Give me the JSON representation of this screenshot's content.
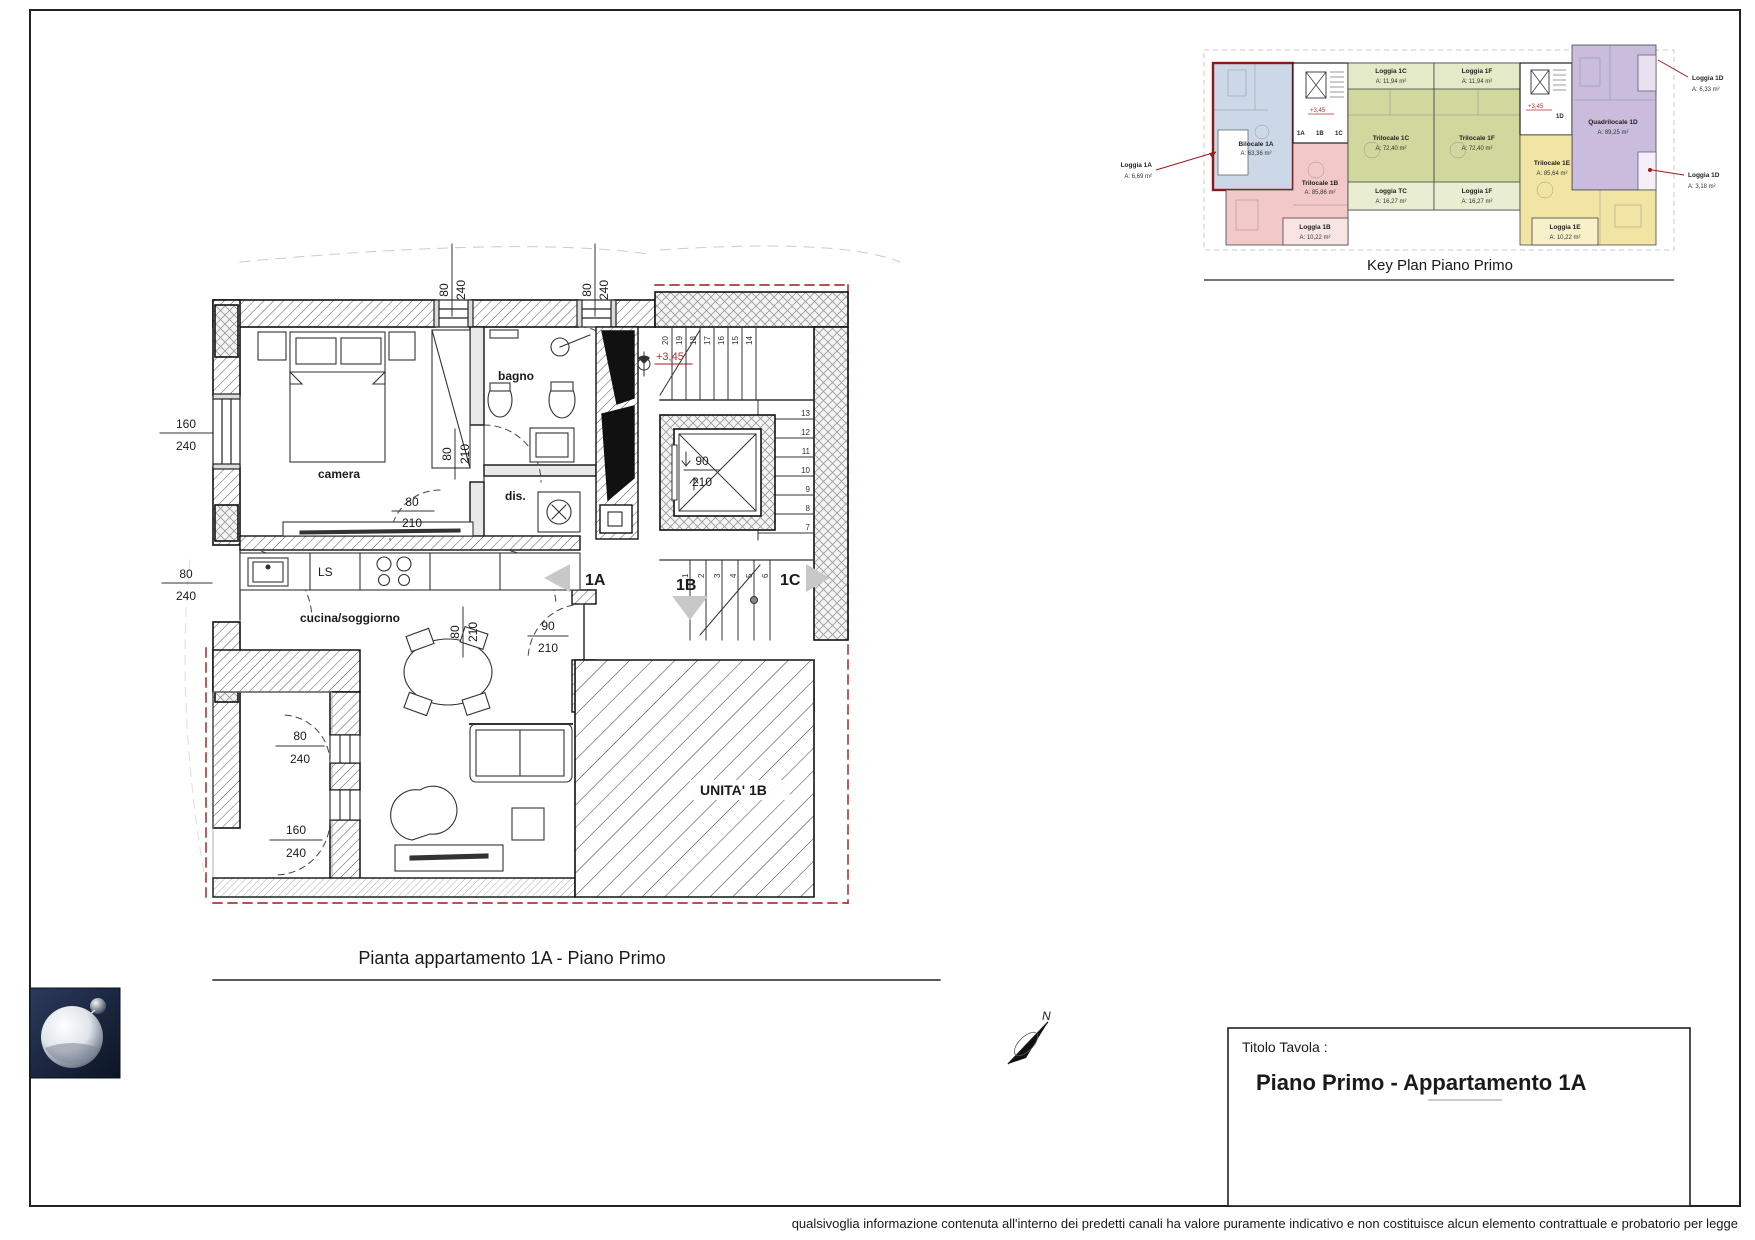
{
  "colors": {
    "red_accent": "#a01818",
    "unit_blue": "#ccd8e8",
    "unit_pink": "#f2c8c8",
    "unit_green": "#d0d89e",
    "unit_purple": "#c9bcdc",
    "unit_yellow": "#f2e5a4",
    "logo_navy": "#16233f"
  },
  "plan": {
    "title": "Pianta appartamento 1A - Piano Primo",
    "rooms": {
      "camera": "camera",
      "bagno": "bagno",
      "dis": "dis.",
      "cucina": "cucina/soggiorno",
      "ls": "LS",
      "unita1b": "UNITA' 1B"
    },
    "unit_markers": [
      "1A",
      "1B",
      "1C"
    ],
    "level": "+3,45",
    "dims": {
      "w80": "80",
      "w90": "90",
      "w160": "160",
      "h210": "210",
      "h240": "240"
    },
    "stairs_top": [
      "20",
      "19",
      "18",
      "17",
      "16",
      "15",
      "14"
    ],
    "stairs_right": [
      "13",
      "12",
      "11",
      "10",
      "9",
      "8",
      "7"
    ],
    "stairs_low": [
      "1",
      "2",
      "3",
      "4",
      "5",
      "6"
    ]
  },
  "keyplan": {
    "title": "Key Plan Piano Primo",
    "level": "+3,45",
    "unit_tags": [
      "1A",
      "1B",
      "1C",
      "1D"
    ],
    "units": [
      {
        "name": "Bilocale 1A",
        "area": "A: 63,36 m²"
      },
      {
        "name": "Trilocale 1B",
        "area": "A: 85,86 m²"
      },
      {
        "name": "Trilocale 1C",
        "area": "A: 72,40 m²"
      },
      {
        "name": "Trilocale 1F",
        "area": "A: 72,40 m²"
      },
      {
        "name": "Quadrilocale 1D",
        "area": "A: 89,25 m²"
      },
      {
        "name": "Trilocale 1E",
        "area": "A: 85,64 m²"
      }
    ],
    "loggias": [
      {
        "name": "Loggia 1A",
        "area": "A: 6,69 m²"
      },
      {
        "name": "Loggia 1B",
        "area": "A: 10,22 m²"
      },
      {
        "name": "Loggia 1C",
        "area": "A: 11,94 m²"
      },
      {
        "name": "Loggia 1F",
        "area": "A: 11,94 m²"
      },
      {
        "name": "Loggia TC",
        "area": "A: 16,27 m²"
      },
      {
        "name": "Loggia 1F",
        "area": "A: 16,27 m²"
      },
      {
        "name": "Loggia 1D",
        "area": "A: 6,33 m²"
      },
      {
        "name": "Loggia 1D",
        "area": "A: 3,18 m²"
      },
      {
        "name": "Loggia 1E",
        "area": "A: 10,22 m²"
      }
    ]
  },
  "titleblock": {
    "label": "Titolo Tavola :",
    "title": "Piano Primo - Appartamento 1A"
  },
  "north": {
    "label": "N"
  },
  "footer": {
    "text": "qualsivoglia informazione contenuta all'interno dei predetti canali ha valore puramente indicativo e non costituisce alcun elemento contrattuale e probatorio per legge"
  }
}
